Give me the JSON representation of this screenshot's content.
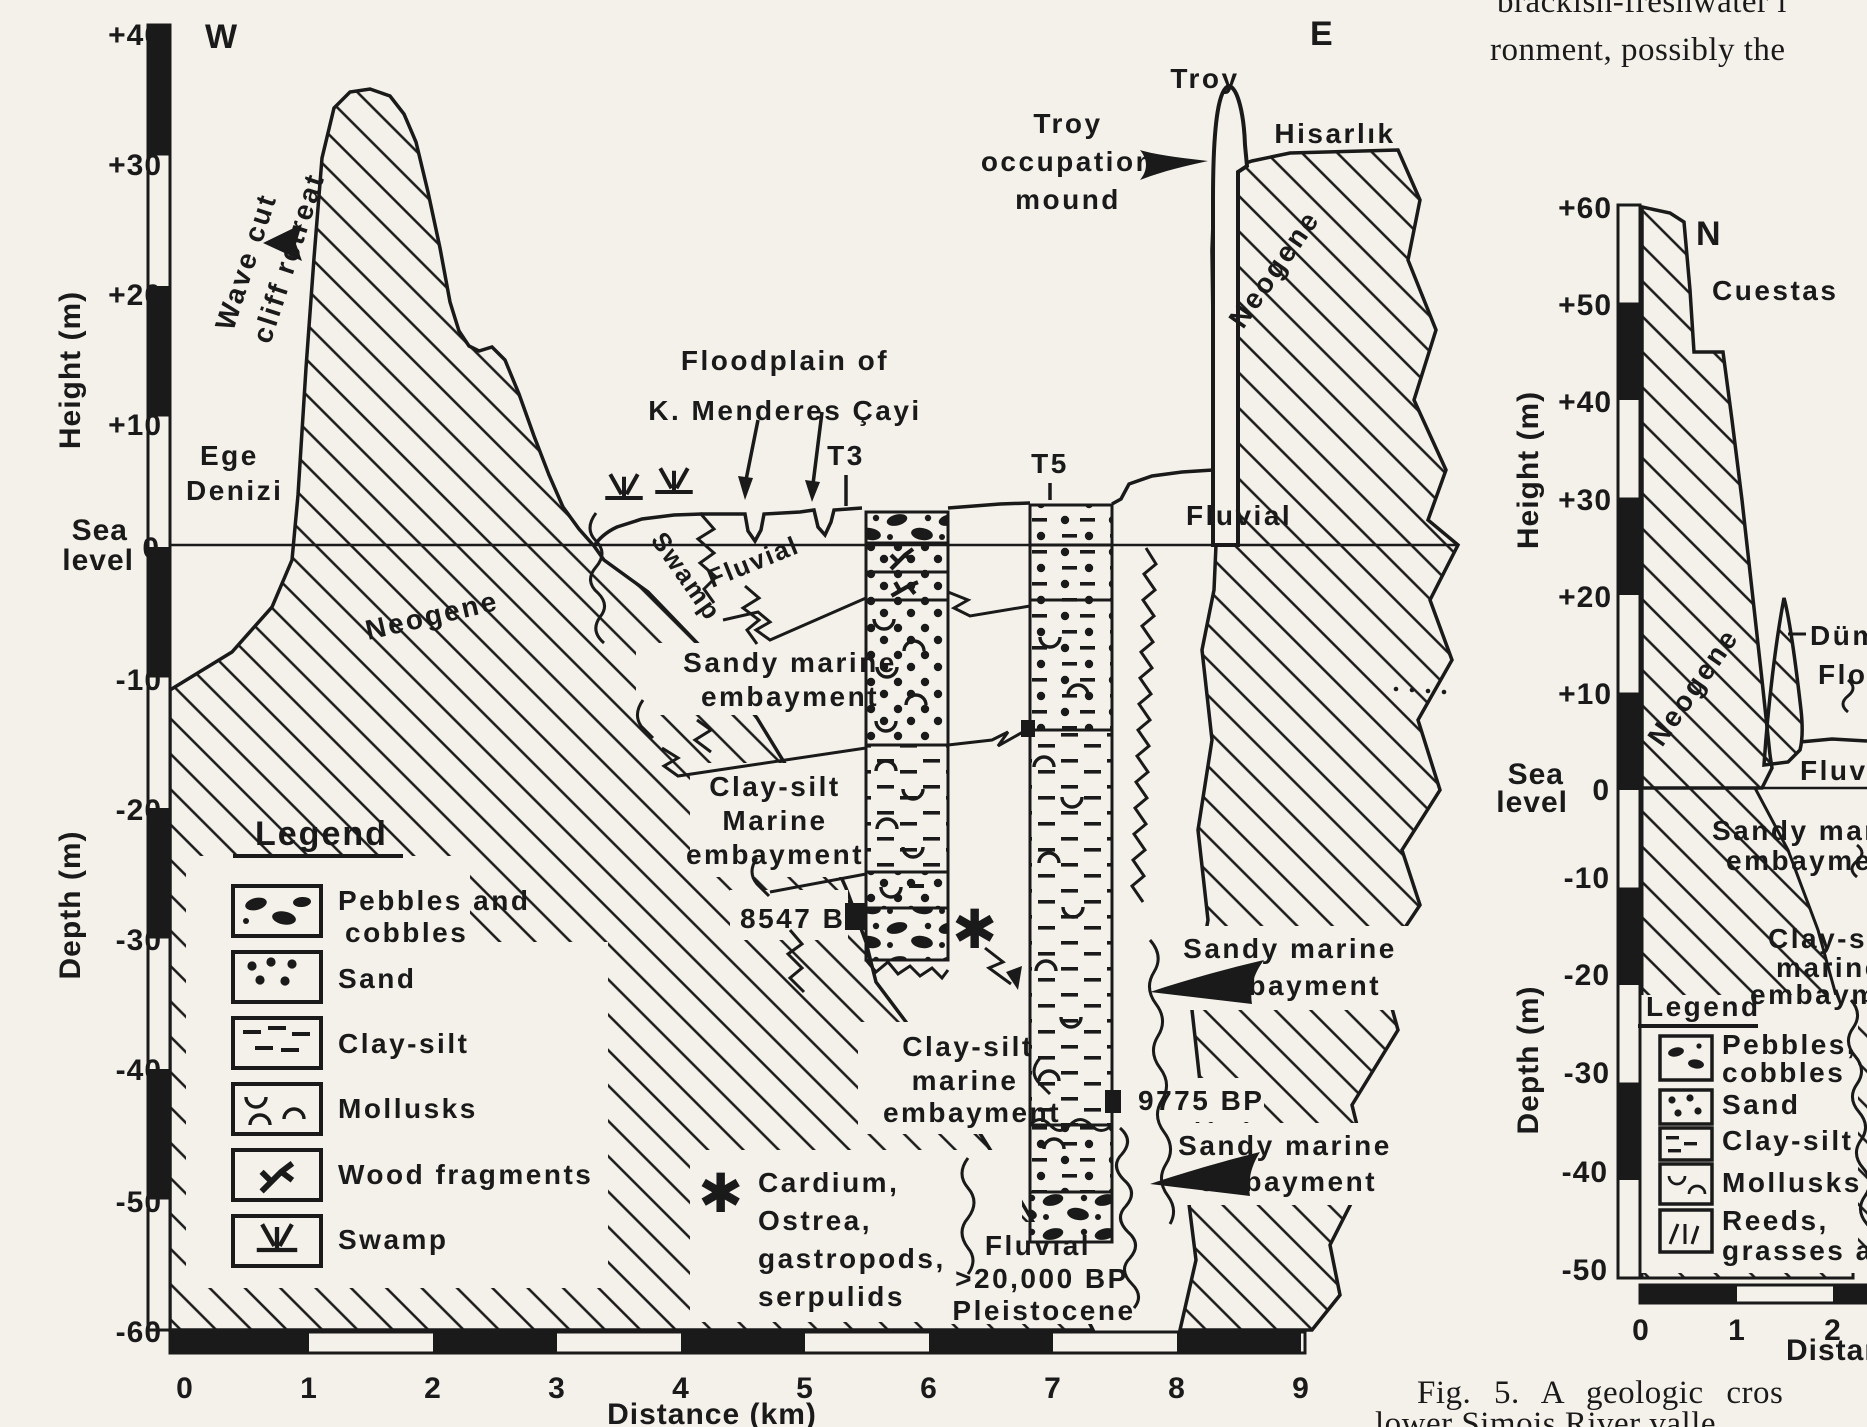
{
  "colors": {
    "paper": "#f4f1ea",
    "ink": "#1a1a1a"
  },
  "page_text": {
    "top_fragment_line1": "brackish-freshwater i",
    "top_fragment_line2": "ronment, possibly the",
    "caption_line1": "Fig. 5. A geologic cros",
    "caption_line2": "lower Simois River valle"
  },
  "main": {
    "west": "W",
    "east": "E",
    "height_axis": "Height (m)",
    "depth_axis": "Depth (m)",
    "sea": "Sea",
    "level": "level",
    "zero": "0",
    "ticks_up": [
      "+40",
      "+30",
      "+20",
      "+10"
    ],
    "ticks_down": [
      "-10",
      "-20",
      "-30",
      "-40",
      "-50",
      "-60"
    ],
    "x_ticks": [
      "0",
      "1",
      "2",
      "3",
      "4",
      "5",
      "6",
      "7",
      "8",
      "9"
    ],
    "x_label": "Distance (km)",
    "labels": {
      "wave_cut_1": "Wave cut",
      "wave_cut_2": "cliff retreat",
      "ege_1": "Ege",
      "ege_2": "Denizi",
      "neogene_left": "Neogene",
      "neogene_right": "Neogene",
      "floodplain_1": "Floodplain of",
      "floodplain_2": "K. Menderes Çayi",
      "swamp": "Swamp",
      "fluvial_plain": "Fluvial",
      "fluvial_terrace": "Fluvial",
      "t3": "T3",
      "t5": "T5",
      "sandy_marine_1": "Sandy marine",
      "sandy_marine_2": "embayment",
      "clay_marine_1": "Clay-silt",
      "clay_marine_2": "Marine",
      "clay_marine_3": "embayment",
      "date_8547": "8547 BP",
      "asterisk": "✱",
      "clay_lower_1": "Clay-silt",
      "clay_lower_2": "marine",
      "clay_lower_3": "embayment",
      "fossil_1": "Cardium,",
      "fossil_2": "Ostrea,",
      "fossil_3": "gastropods,",
      "fossil_4": "serpulids",
      "fluvial_deep": "Fluvial",
      "date_20000": ">20,000 BP",
      "pleistocene": "Pleistocene",
      "date_9775": "9775 BP",
      "sandy_r1_1": "Sandy marine",
      "sandy_r1_2": "embayment",
      "sandy_r2_1": "Sandy marine",
      "sandy_r2_2": "embayment",
      "troy": "Troy",
      "troy_mound_1": "Troy",
      "troy_mound_2": "occupation",
      "troy_mound_3": "mound",
      "hisarlik": "Hisarlık"
    },
    "legend": {
      "title": "Legend",
      "items": [
        {
          "key": "pebbles-cobbles",
          "line1": "Pebbles and",
          "line2": "cobbles"
        },
        {
          "key": "sand",
          "line1": "Sand"
        },
        {
          "key": "clay-silt",
          "line1": "Clay-silt"
        },
        {
          "key": "mollusks",
          "line1": "Mollusks"
        },
        {
          "key": "wood-fragments",
          "line1": "Wood fragments"
        },
        {
          "key": "swamp",
          "line1": "Swamp"
        }
      ]
    }
  },
  "fig5": {
    "north": "N",
    "cuestas": "Cuestas",
    "height_axis": "Height (m)",
    "depth_axis": "Depth (m)",
    "sea": "Sea",
    "level": "level",
    "zero": "0",
    "ticks_up": [
      "+60",
      "+50",
      "+40",
      "+30",
      "+20",
      "+10"
    ],
    "ticks_down": [
      "-10",
      "-20",
      "-30",
      "-40",
      "-50"
    ],
    "x_ticks": [
      "0",
      "1",
      "2"
    ],
    "x_label": "Distan",
    "labels": {
      "neogene": "Neogene",
      "dumrek": "Dümr",
      "floodplain": "Floo",
      "fluvial": "Fluvia",
      "sandy_1": "Sandy marin",
      "sandy_2": "embayment",
      "clay_1": "Clay-silt",
      "clay_2": "marine",
      "clay_3": "embayme"
    },
    "legend": {
      "title": "Legend",
      "items": [
        {
          "key": "pebbles-cobbles",
          "line1": "Pebbles,",
          "line2": "cobbles"
        },
        {
          "key": "sand",
          "line1": "Sand"
        },
        {
          "key": "clay-silt",
          "line1": "Clay-silt"
        },
        {
          "key": "mollusks",
          "line1": "Mollusks"
        },
        {
          "key": "reeds-grasses",
          "line1": "Reeds,",
          "line2": "grasses an"
        }
      ]
    }
  }
}
